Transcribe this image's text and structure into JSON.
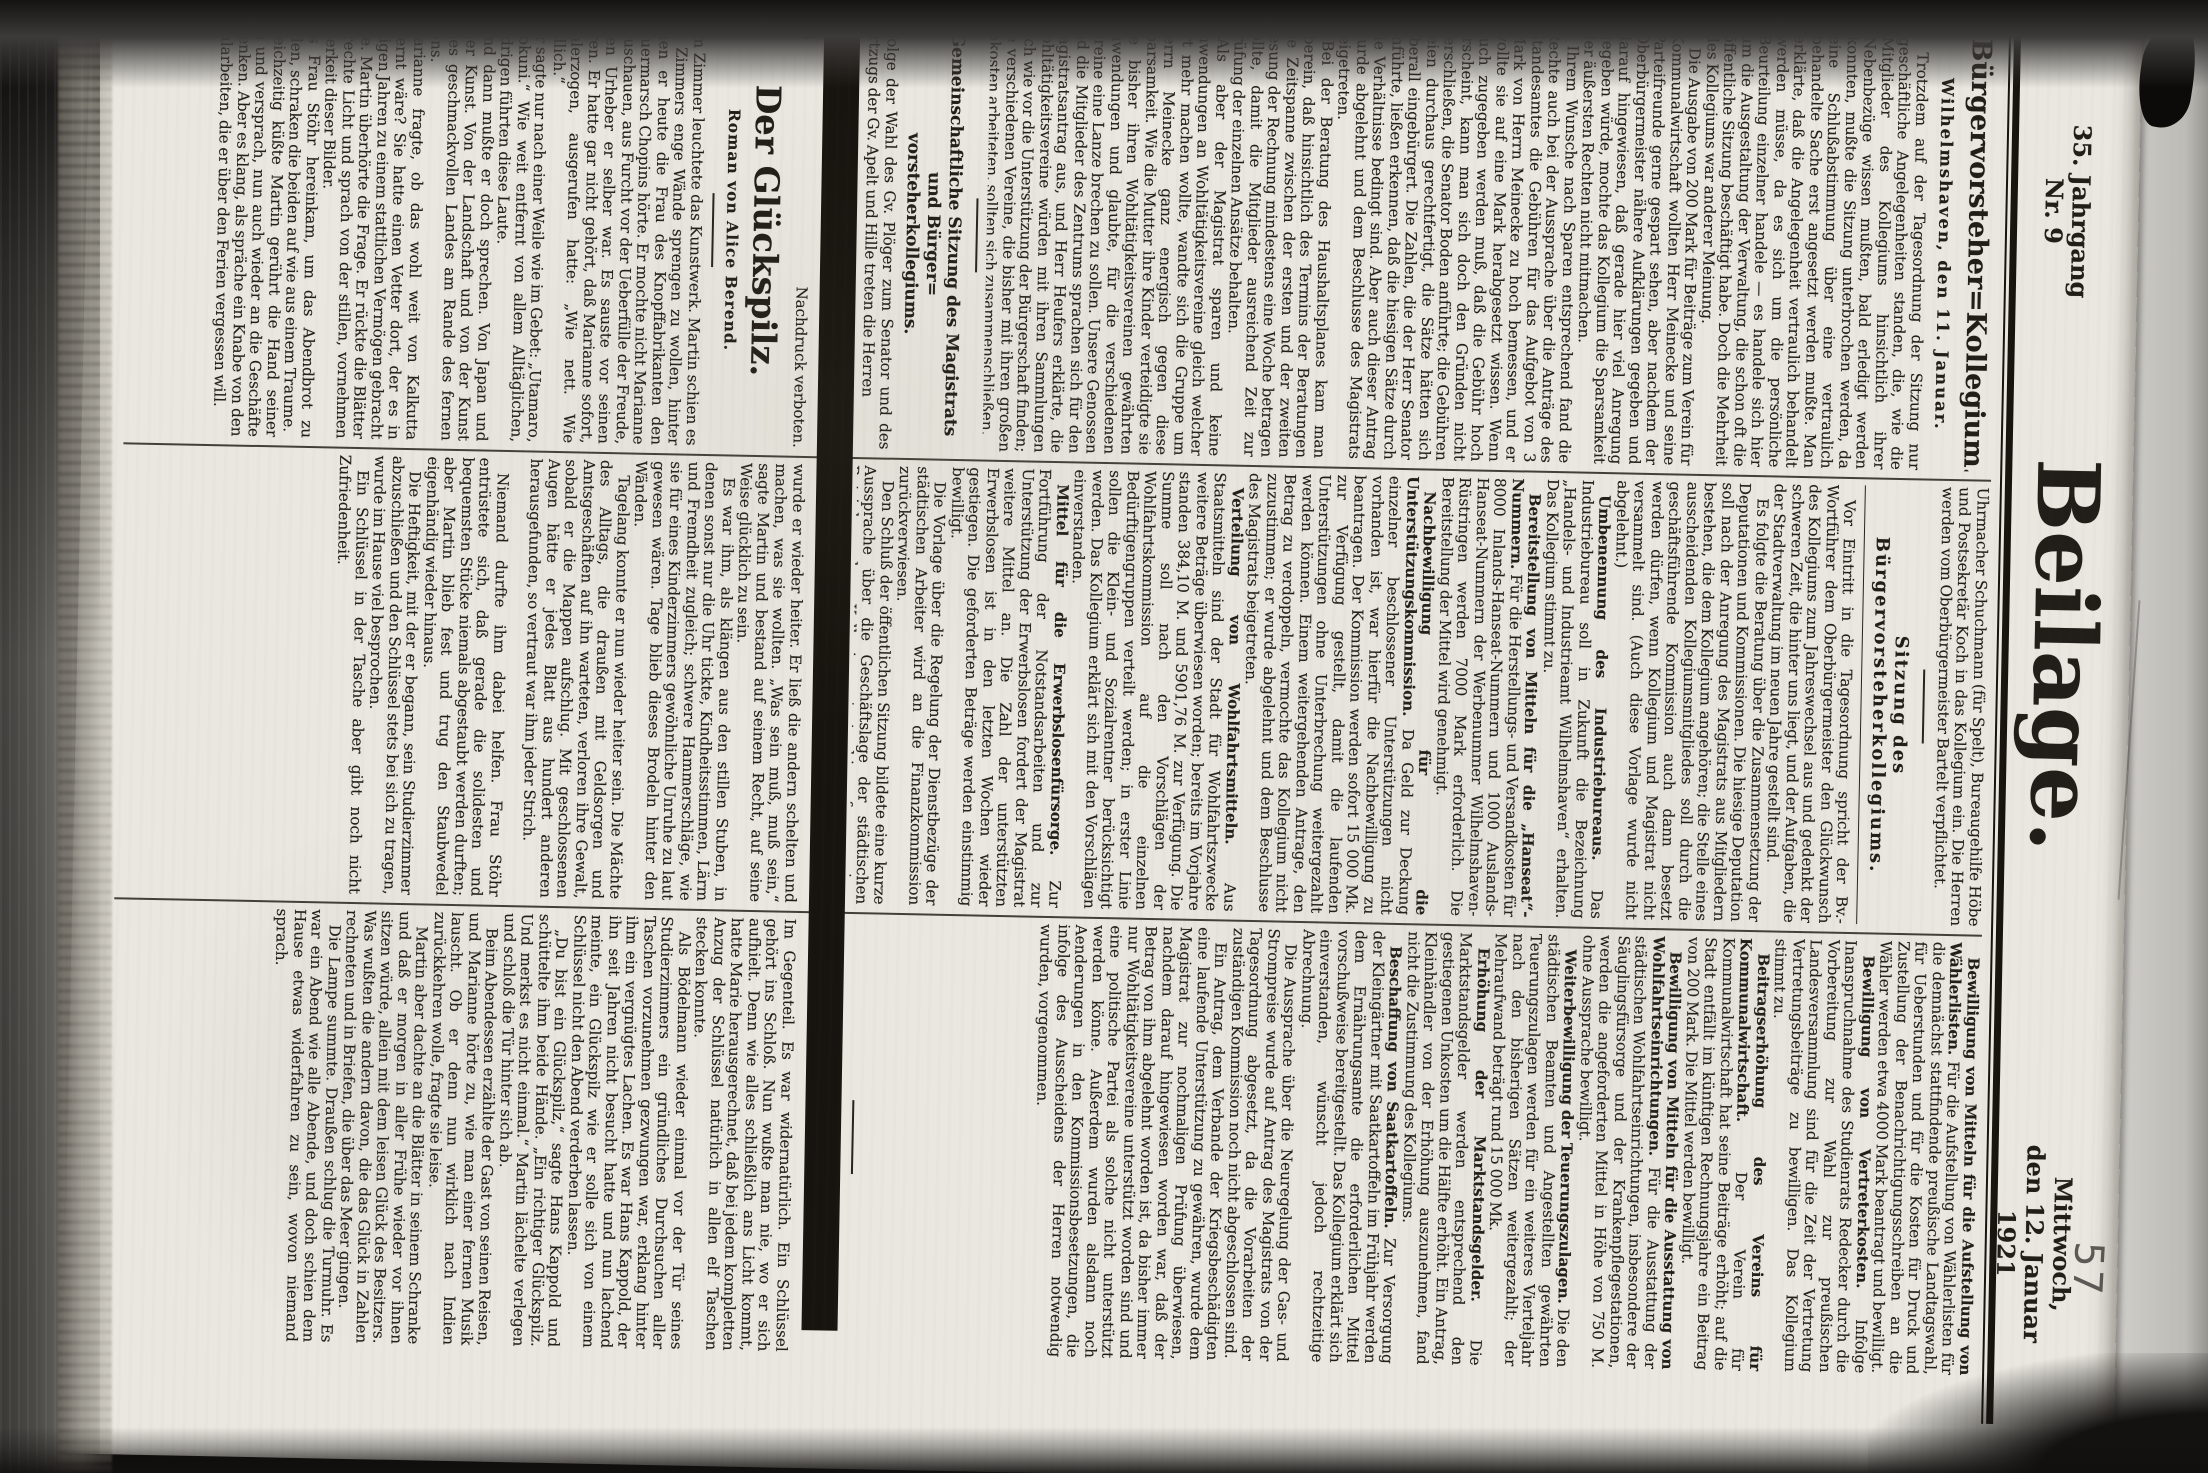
{
  "masthead": {
    "title": "Beilage.",
    "volume": "35. Jahrgang",
    "issue": "Nr. 9",
    "date_line1": "Mittwoch,",
    "date_line2": "den 12. Januar 1921",
    "page_number_hand": "57",
    "paper_color": "#e9e7e0",
    "ink_color": "#211d18"
  },
  "news": {
    "col1": {
      "headline": "Bürgervorsteher=Kollegium.",
      "dateline": "Wilhelmshaven, den 11. Januar.",
      "paragraphs": [
        "Trotzdem auf der Tagesordnung der Sitzung nur geschäftliche Angelegenheiten standen, die, wie die Mitglieder des Kollegiums hinsichtlich ihrer Nebenbezüge wissen mußten, bald erledigt werden konnten, mußte die Sitzung unterbrochen werden, da eine Schlußabstimmung über eine vertraulich behandelte Sache erst angesetzt werden mußte. Man erklärte, daß die Angelegenheit vertraulich behandelt werden müsse, da es sich um die persönliche Beurteilung einzelner handele — es handele sich hier um die Ausgestaltung der Verwaltung, die schon oft die öffentliche Sitzung beschäftigt habe. Doch die Mehrheit des Kollegiums war anderer Meinung.",
        "Die Ausgabe von 200 Mark für Beiträge zum Verein für Kommunalwirtschaft wollten Herr Meinecke und seine Parteifreunde gerne gespart sehen, aber nachdem der Oberbürgermeister nähere Aufklärungen gegeben und darauf hingewiesen, daß gerade hier viel Anregung gegeben würde, mochte das Kollegium die Sparsamkeit der äußersten Rechten nicht mitmachen.",
        "Ihrem Wunsche nach Sparen entsprechend fand die Rechte auch bei der Aussprache über die Anträge des Standesamtes die Gebühren für das Aufgebot von 3 Mark von Herrn Meinecke zu hoch bemessen, und er wollte sie auf eine Mark herabgesetzt wissen. Wenn auch zugegeben werden muß, daß die Gebühr hoch erscheint, kann man sich doch den Gründen nicht verschließen, die Senator Boden anführte; die Gebühren seien durchaus gerechtfertigt, die Sätze hätten sich überall eingebürgert. Die Zahlen, die der Herr Senator anführte, ließen erkennen, daß die hiesigen Sätze durch die Verhältnisse bedingt sind. Aber auch dieser Antrag wurde abgelehnt und dem Beschlusse des Magistrats beigetreten.",
        "Bei der Beratung des Haushaltsplanes kam man überein, daß hinsichtlich des Termins der Beratungen die Zeitspanne zwischen der ersten und der zweiten Lesung der Rechnung mindestens eine Woche betragen sollte, damit die Mitglieder ausreichend Zeit zur Prüfung der einzelnen Ansätze behalten.",
        "Als aber der Magistrat sparen und keine Zuwendungen an Wohltätigkeitsvereine gleich welcher Art mehr machen wollte, wandte sich die Gruppe um Herrn Meinecke ganz energisch gegen diese Sparsamkeit. Wie die Mutter ihre Kinder verteidigte sie die bisher ihren Wohltätigkeitsvereinen gewährten Zuwendungen und glaubte, für die verschiedenen Vereine eine Lanze brechen zu sollen. Unsere Genossen und die Mitglieder des Zentrums sprachen sich für den Magistratsantrag aus, und Herr Heufers erklärte, die Wohltätigkeitsvereine würden mit ihren Sammlungen nach wie vor die Unterstützung der Bürgerschaft finden; die verschiedenen Vereine, die bisher mit ihren großen Unkosten arbeiteten, sollten sich zusammenschließen.",
        "Nach diesem Tagesordnungspunkte entschloß man sich, das Weitere vorerst einmal vertraulich zu verhandeln."
      ],
      "bottom_heading_line1": "Gemeinschaftliche Sitzung des Magistrats und Bürger=",
      "bottom_heading_line2": "vorsteherkollegiums.",
      "closing_paragraph": "Infolge der Wahl des Gv. Plöger zum Senator und des Fortzugs der Gv. Apelt und Hille treten die Herren"
    },
    "col2": {
      "continuation": "Uhrmacher Schuchmann (für Spelt), Bureaugehilfe Höbe und Postsekretär Koch in das Kollegium ein. Die Herren werden vom Oberbürgermeister Bartelt verpflichtet.",
      "subheading": "Sitzung des Bürgervorsteherkollegiums.",
      "paragraphs": [
        "Vor Eintritt in die Tagesordnung spricht der Bv.-Wortführer dem Oberbürgermeister den Glückwunsch des Kollegiums zum Jahreswechsel aus und gedenkt der schweren Zeit, die hinter uns liegt, und der Aufgaben, die der Stadtverwaltung im neuen Jahre gestellt sind.",
        "Es folgte die Beratung über die Zusammensetzung der Deputationen und Kommissionen. Die hiesige Deputation soll nach der Anregung des Magistrats aus Mitgliedern bestehen, die dem Kollegium angehören; die Stelle eines ausscheidenden Kollegiumsmitgliedes soll durch die geschäftsführende Kommission auch dann besetzt werden dürfen, wenn Kollegium und Magistrat nicht versammelt sind. (Auch diese Vorlage wurde nicht abgelehnt.)",
        {
          "lead": "Umbenennung des Industriebureaus.",
          "text": "Das Industriebureau soll in Zukunft die Bezeichnung „Handels- und Industrieamt Wilhelmshaven“ erhalten. Das Kollegium stimmt zu."
        },
        {
          "lead": "Bereitstellung von Mitteln für die „Hanseat“-Nummern.",
          "text": "Für die Herstellungs- und Versandkosten für 8000 Inlands-Hanseat-Nummern und 1000 Auslands-Hanseat-Nummern der Werbenummer Wilhelmshaven-Rüstringen werden 7000 Mark erforderlich. Die Bereitstellung der Mittel wird genehmigt."
        },
        {
          "lead": "Nachbewilligung für die Unterstützungskommission.",
          "text": "Da Geld zur Deckung einzelner beschlossener Unterstützungen nicht vorhanden ist, war hierfür die Nachbewilligung zu beantragen. Der Kommission werden sofort 15 000 Mk. zur Verfügung gestellt, damit die laufenden Unterstützungen ohne Unterbrechung weitergezahlt werden können. Einem weitergehenden Antrage, den Betrag zu verdoppeln, vermochte das Kollegium nicht zuzustimmen; er wurde abgelehnt und dem Beschlusse des Magistrats beigetreten."
        },
        {
          "lead": "Verteilung von Wohlfahrtsmitteln.",
          "text": "Aus Staatsmitteln sind der Stadt für Wohlfahrtszwecke weitere Beträge überwiesen worden; bereits im Vorjahre standen 384,10 M. und 5901,76 M. zur Verfügung. Die Summe soll nach den Vorschlägen der Wohlfahrtskommission auf die einzelnen Bedürftigengruppen verteilt werden; in erster Linie sollen die Klein- und Sozialrentner berücksichtigt werden. Das Kollegium erklärt sich mit den Vorschlägen einverstanden."
        },
        {
          "lead": "Mittel für die Erwerbslosenfürsorge.",
          "text": "Zur Fortführung der Notstandsarbeiten und zur Unterstützung der Erwerbslosen fordert der Magistrat weitere Mittel an. Die Zahl der unterstützten Erwerbslosen ist in den letzten Wochen wieder gestiegen. Die geforderten Beträge werden einstimmig bewilligt."
        },
        "Die Vorlage über die Regelung der Dienstbezüge der städtischen Arbeiter wird an die Finanzkommission zurückverwiesen.",
        "Den Schluß der öffentlichen Sitzung bildete eine kurze Aussprache über die Geschäftslage der städtischen Betriebe; das Kollegium trat hierauf zu einer vertraulichen Beratung zusammen."
      ]
    },
    "col3": {
      "paragraphs": [
        {
          "lead": "Bewilligung von Mitteln für die Aufstellung von Wählerlisten.",
          "text": "Für die Aufstellung von Wählerlisten für die demnächst stattfindende preußische Landtagswahl, für Ueberstunden und für die Kosten für Druck und Zustellung der Benachrichtigungsschreiben an die Wähler werden etwa 4000 Mark beantragt und bewilligt."
        },
        {
          "lead": "Bewilligung von Vertreterkosten.",
          "text": "Infolge Inanspruchnahme des Studienrats Redecker durch die Vorbereitung zur Wahl zur preußischen Landesversammlung sind für die Zeit der Vertretung Vertretungsbeiträge zu bewilligen. Das Kollegium stimmt zu."
        },
        {
          "lead": "Beitragserhöhung des Vereins für Kommunalwirtschaft.",
          "text": "Der Verein für Kommunalwirtschaft hat seine Beiträge erhöht; auf die Stadt entfällt im künftigen Rechnungsjahre ein Beitrag von 200 Mark. Die Mittel werden bewilligt."
        },
        {
          "lead": "Bewilligung von Mitteln für die Ausstattung von Wohlfahrtseinrichtungen.",
          "text": "Für die Ausstattung der städtischen Wohlfahrtseinrichtungen, insbesondere der Säuglingsfürsorge und der Krankenpflegestationen, werden die angeforderten Mittel in Höhe von 750 M. ohne Aussprache bewilligt."
        },
        {
          "lead": "Weiterbewilligung der Teuerungszulagen.",
          "text": "Die den städtischen Beamten und Angestellten gewährten Teuerungszulagen werden für ein weiteres Vierteljahr nach den bisherigen Sätzen weitergezahlt; der Mehraufwand beträgt rund 15 000 Mk."
        },
        {
          "lead": "Erhöhung der Marktstandsgelder.",
          "text": "Die Marktstandsgelder werden entsprechend den gestiegenen Unkosten um die Hälfte erhöht. Ein Antrag, Kleinhändler von der Erhöhung auszunehmen, fand nicht die Zustimmung des Kollegiums."
        },
        {
          "lead": "Beschaffung von Saatkartoffeln.",
          "text": "Zur Versorgung der Kleingärtner mit Saatkartoffeln im Frühjahr werden dem Ernährungsamte die erforderlichen Mittel vorschußweise bereitgestellt. Das Kollegium erklärt sich einverstanden, wünscht jedoch rechtzeitige Abrechnung."
        },
        "Die Aussprache über die Neuregelung der Gas- und Strompreise wurde auf Antrag des Magistrats von der Tagesordnung abgesetzt, da die Vorarbeiten der zuständigen Kommission noch nicht abgeschlossen sind.",
        "Ein Antrag, dem Verbande der Kriegsbeschädigten eine laufende Unterstützung zu gewähren, wurde dem Magistrat zur nochmaligen Prüfung überwiesen, nachdem darauf hingewiesen worden war, daß der Betrag von ihm abgelehnt worden ist, da bisher immer nur Wohltätigkeitsvereine unterstützt worden sind und eine politische Partei als solche nicht unterstützt werden könne. Außerdem wurden alsdann noch Aenderungen in den Kommissionsbesetzungen, die infolge des Ausscheidens der Herren notwendig wurden, vorgenommen."
      ]
    }
  },
  "feuilleton": {
    "installment": "14)",
    "rights": "Nachdruck verboten.",
    "title": "Der Glückspilz.",
    "byline": "Roman von Alice Berend.",
    "col1_paragraphs": [
      "Im Zimmer leuchtete das Kunstwerk. Martin schien es des Zimmers enge Wände sprengen zu wollen, hinter denen er heute die Frau des Knopffabrikanten den Trauermarsch Chopins hörte. Er mochte nicht Marianne anzuschauen, aus Furcht vor der Ueberfülle der Freude, deren Urheber er selber war. Es sauste vor seinen Ohren. Er hatte gar nicht gehört, daß Marianne sofort, wohlerzogen, ausgerufen hatte: „Wie nett. Wie niedlich.“",
      "Er sagte nur nach einer Weile wie im Gebet: „Utamaro, Toyokuni.“ Wie weit entfernt von allem Alltäglichen, Niedrigen führten diese Laute.",
      "Und dann mußte er doch sprechen. Von Japan und seiner Kunst. Von der Landschaft und von der Kunst dieses geschmackvollen Landes am Rande des fernen Asiens.",
      "Marianne fragte, ob das wohl weit von Kalkutta entfernt wäre? Sie hatte einen Vetter dort, der es in wenigen Jahren zu einem stattlichen Vermögen gebracht hatte. Martin überhörte die Frage. Er rückte die Blätter ins rechte Licht und sprach von der stillen, vornehmen Heiterkeit dieser Bilder.",
      "Als Frau Stöhr hereinkam, um das Abendbrot zu melden, schraken die beiden auf wie aus einem Traume.",
      "Gleichzeitig küßte Martin gerührt die Hand seiner Frau und versprach, nun auch wieder an die Geschäfte zu denken. Aber es klang, als spräche ein Knabe von den Schularbeiten, die er über den Ferien vergessen will."
    ],
    "col2_paragraphs": [
      {
        "text": "wurde er wieder heiter. Er ließ die andern schelten und machen, was sie wollten. „Was sein muß, muß sein,“ sagte Martin und bestand auf seinem Recht, auf seine Weise glücklich zu sein.",
        "no_indent": true
      },
      "Es war ihm, als klängen aus den stillen Stuben, in denen sonst nur die Uhr tickte, Kindheitsstimmen, Lärm und Fremdheit zugleich; schwere Hammerschläge, wie sie für eines Kinderzimmers gewöhnliche Unruhe zu laut gewesen wären. Tage blieb dieses Brodeln hinter den Wänden.",
      {
        "text": "Tagelang konnte er nun wieder heiter sein. Die Mächte des Alltags, die draußen mit Geldsorgen und Amtsgeschäften auf ihn warteten, verloren ihre Gewalt, sobald er die Mappen aufschlug. Mit geschlossenen Augen hätte er jedes Blatt aus hundert anderen herausgefunden, so vertraut war ihm jeder Strich.",
        "gap_after": true
      },
      "Niemand durfte ihm dabei helfen. Frau Stöhr entrüstete sich, daß gerade die solidesten und bequemsten Stücke niemals abgestaubt werden durften; aber Martin blieb fest und trug den Staubwedel eigenhändig wieder hinaus.",
      "Die Heftigkeit, mit der er begann, sein Studierzimmer abzuschließen und den Schlüssel stets bei sich zu tragen, wurde im Hause viel besprochen.",
      "Ein Schlüssel in der Tasche aber gibt noch nicht Zufriedenheit."
    ],
    "col3_paragraphs": [
      {
        "text": "Im Gegenteil. Es war widernatürlich. Ein Schlüssel gehört ins Schloß. Nun wußte man nie, wo er sich aufhielt. Denn wie alles schließlich ans Licht kommt, hatte Marie herausgerechnet, daß bei jedem kompletten Anzug der Schlüssel natürlich in allen elf Taschen stecken konnte.",
        "no_indent": true
      },
      "Als Bödelmann wieder einmal vor der Tür seines Studierzimmers ein gründliches Durchsuchen aller Taschen vorzunehmen gezwungen war, erklang hinter ihm ein vergnügtes Lachen. Es war Hans Kappold, der ihn seit Jahren nicht besucht hatte und nun lachend meinte, ein Glückspilz wie er solle sich von einem Schlüssel nicht den Abend verderben lassen.",
      "„Du bist ein Glückspilz,“ sagte Hans Kappold und schüttelte ihm beide Hände. „Ein richtiger Glückspilz. Und merkst es nicht einmal.“ Martin lächelte verlegen und schloß die Tür hinter sich ab.",
      "Beim Abendessen erzählte der Gast von seinen Reisen, und Marianne hörte zu, wie man einer fernen Musik lauscht. Ob er denn nun wirklich nach Indien zurückkehren wolle, fragte sie leise.",
      "Martin aber dachte an die Blätter in seinem Schranke und daß er morgen in aller Frühe wieder vor ihnen sitzen würde, allein mit dem leisen Glück des Besitzers. Was wußten die andern davon, die das Glück in Zahlen rechneten und in Briefen, die über das Meer gingen.",
      "Die Lampe summte. Draußen schlug die Turmuhr. Es war ein Abend wie alle Abende, und doch schien dem Hause etwas widerfahren zu sein, wovon niemand sprach."
    ]
  }
}
